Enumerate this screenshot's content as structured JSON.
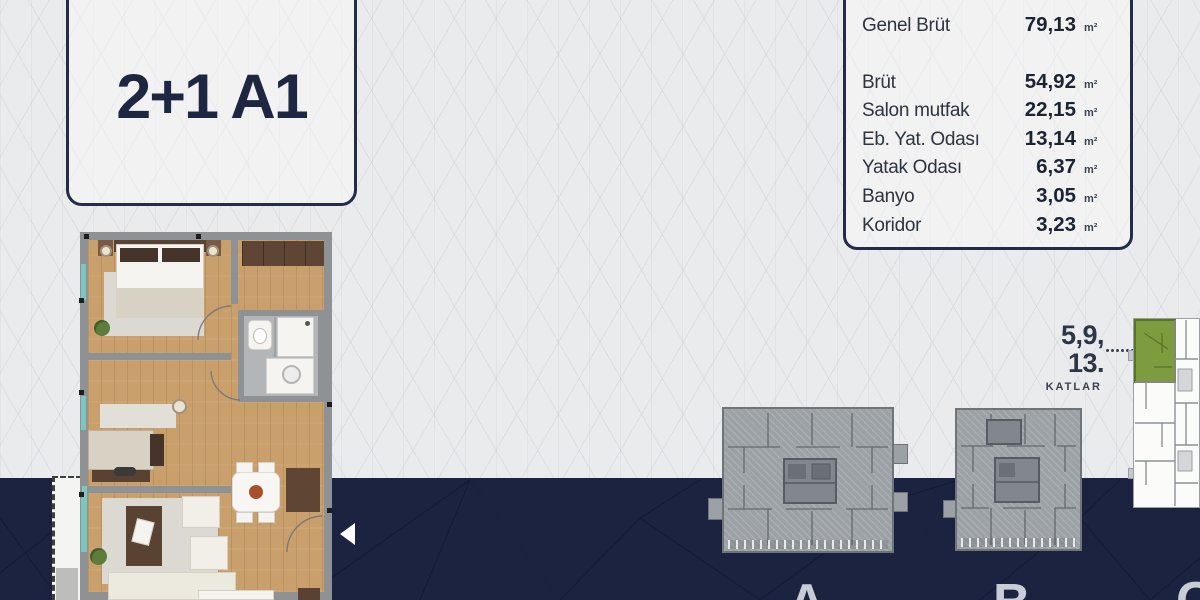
{
  "title_card": {
    "label": "2+1 A1"
  },
  "area_card": {
    "summary_row": {
      "label": "Genel Brüt",
      "value": "79,13",
      "unit": "m²"
    },
    "rows": [
      {
        "label": "Brüt",
        "value": "54,92",
        "unit": "m²"
      },
      {
        "label": "Salon mutfak",
        "value": "22,15",
        "unit": "m²"
      },
      {
        "label": "Eb. Yat. Odası",
        "value": "13,14",
        "unit": "m²"
      },
      {
        "label": "Yatak Odası",
        "value": "6,37",
        "unit": "m²"
      },
      {
        "label": "Banyo",
        "value": "3,05",
        "unit": "m²"
      },
      {
        "label": "Koridor",
        "value": "3,23",
        "unit": "m²"
      }
    ]
  },
  "floors_callout": {
    "line1": "5,9,",
    "line2": "13.",
    "caption": "KATLAR"
  },
  "site_plan": {
    "blocks": [
      {
        "label": "A"
      },
      {
        "label": "B"
      },
      {
        "label": "C"
      }
    ],
    "highlighted_block": "C",
    "highlight_color": "#7d9b3f"
  },
  "colors": {
    "navy": "#1b2340",
    "light_bg": "#eaebed",
    "card_border": "#232d49",
    "letter_gray": "#c8ccd5",
    "wood": "#c9a06c",
    "wall_gray": "#8f9294",
    "glass_teal": "#7cc6c2",
    "block_gray": "#9ca1a5",
    "highlight_green": "#7d9b3f",
    "arrow_white": "#ffffff"
  }
}
